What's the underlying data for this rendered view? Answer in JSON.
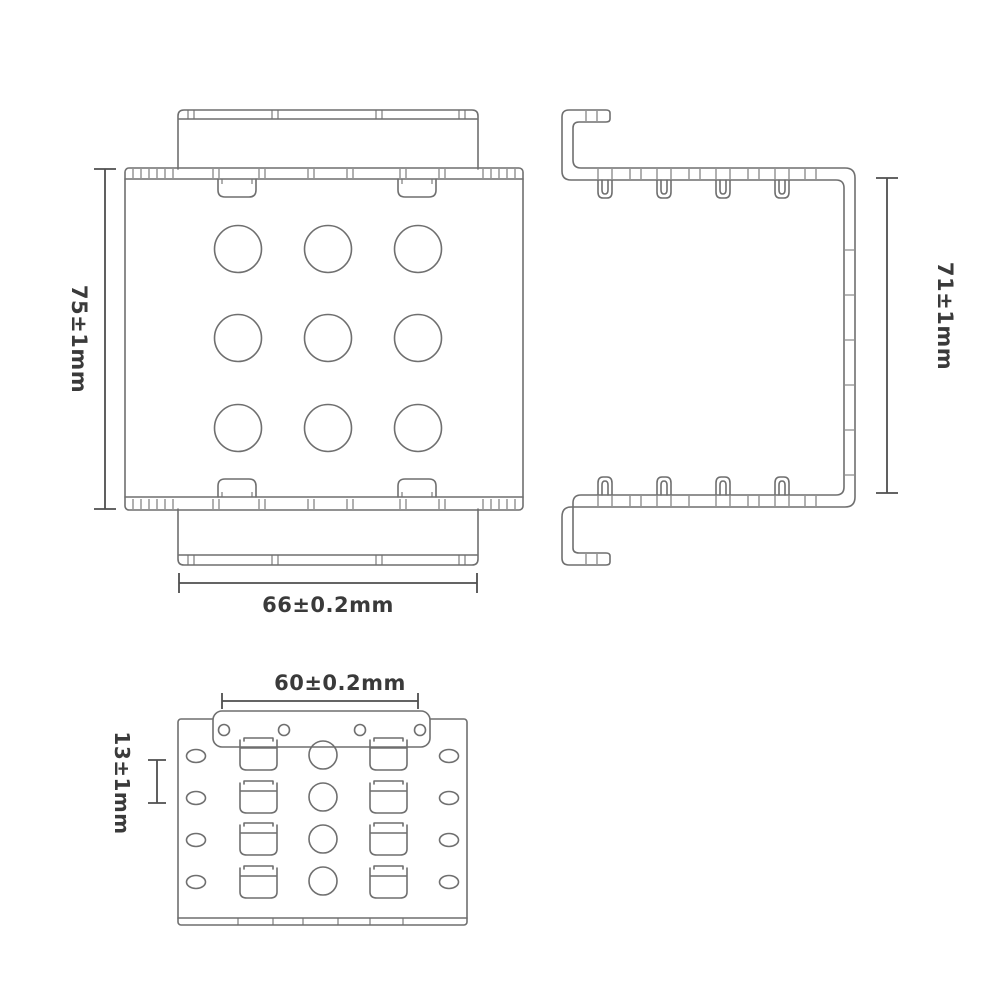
{
  "drawing": {
    "background": "#ffffff",
    "line_color": "#6f6f6f",
    "dim_color": "#4f4f4f",
    "text_color": "#3a3a3a",
    "bar_fill": "#ffffff",
    "dims": {
      "front_height": "75±1mm",
      "front_width": "66±0.2mm",
      "side_height": "71±1mm",
      "bottom_hole_span": "60±0.2mm",
      "bottom_row_pitch": "13±1mm"
    }
  }
}
